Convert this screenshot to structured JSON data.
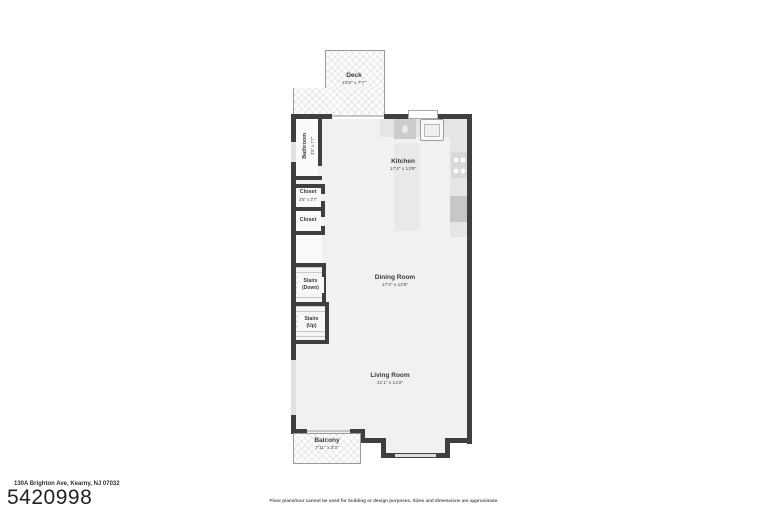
{
  "meta": {
    "address": "130A Brighton Ave, Kearny, NJ 07032",
    "listing_number": "5420998",
    "disclaimer": "Floor plans/tour cannot be used for building or design purposes. Sizes and dimensions are approximate."
  },
  "rooms": {
    "deck": {
      "name": "Deck",
      "dims": "10'8\" x 7'7\""
    },
    "bathroom": {
      "name": "Bathroom",
      "dims": "3'5\" x 7'7\""
    },
    "closet1": {
      "name": "Closet",
      "dims": "3'5\" x 3'7\""
    },
    "closet2": {
      "name": "Closet"
    },
    "stairs_down": {
      "name": "Stairs",
      "sub": "(Down)"
    },
    "stairs_up": {
      "name": "Stairs",
      "sub": "(Up)"
    },
    "kitchen": {
      "name": "Kitchen",
      "dims": "17'4\" x 13'9\""
    },
    "dining_room": {
      "name": "Dining Room",
      "dims": "17'4\" x 12'8\""
    },
    "living_room": {
      "name": "Living Room",
      "dims": "21'1\" x 14'2\""
    },
    "balcony": {
      "name": "Balcony",
      "dims": "7'11\" x 3'3\""
    }
  },
  "fixtures": {
    "icons": [
      "sink-icon",
      "dishwasher-icon",
      "cooktop-icon",
      "refrigerator-icon",
      "kitchen-island",
      "counter"
    ]
  },
  "colors": {
    "wall": "#3f3f3f",
    "floor": "#f1f1f1",
    "counter": "#e5e5e5",
    "appliance": "#c8c8c8",
    "text": "#3a3a3a"
  }
}
